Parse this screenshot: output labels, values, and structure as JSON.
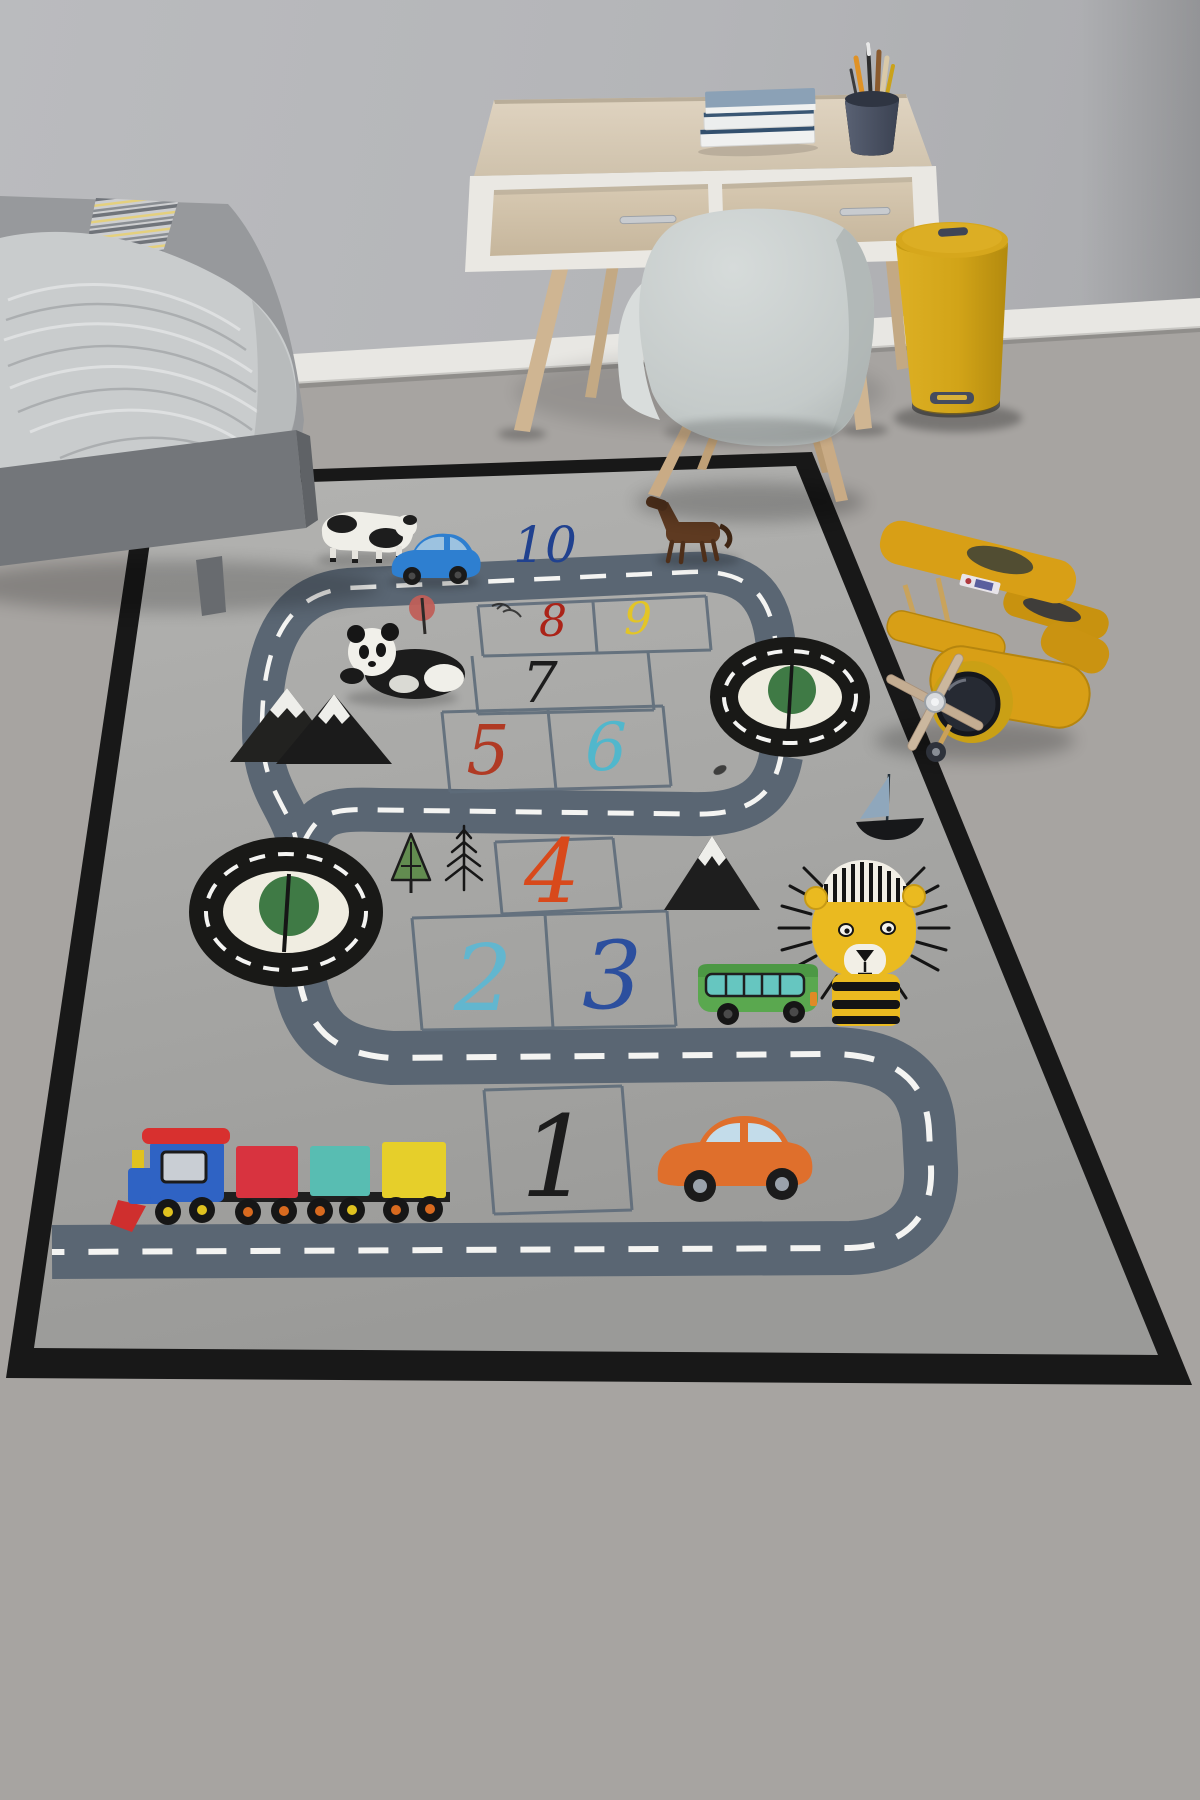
{
  "scene": {
    "setting": "children's room corner with play rug",
    "wall": {
      "color": "#b4b5b8",
      "baseboard_color": "#e8e7e3"
    },
    "floor": {
      "color": "#a7a4a1",
      "material": "concrete"
    },
    "furniture": [
      {
        "name": "bed",
        "frame_color": "#73767a",
        "bedding_color": "#97999c",
        "blanket_color": "#c9cccd",
        "runner_stripe_colors": [
          "#cdced0",
          "#70747a",
          "#e4d07e"
        ]
      },
      {
        "name": "desk",
        "wood_color": "#d6c9b4",
        "trim_color": "#eae8e3",
        "legs_color": "#cfb592",
        "handle_color": "#c8cbcf"
      },
      {
        "name": "book-stack",
        "cover_color": "#8ba1b6",
        "pages_color": "#f0f1f0",
        "count": 3
      },
      {
        "name": "pencil-cup",
        "cup_color": "#495163",
        "pencil_colors": [
          "#e09225",
          "#2d2d2d",
          "#8a5a2e",
          "#d9c9a8",
          "#caa21a"
        ]
      },
      {
        "name": "chair",
        "shell_color": "#c7cdcc",
        "legs_color": "#c9ab85"
      },
      {
        "name": "trash-bin",
        "color": "#d2a418",
        "lid_color": "#d6a71c"
      },
      {
        "name": "toy-biplane",
        "color": "#d89f16",
        "engine_color": "#262a33",
        "propeller_color": "#cbb79e"
      }
    ]
  },
  "rug": {
    "base_color": "#a9a9a7",
    "border_color": "#181818",
    "road_color": "#5a6673",
    "road_dash_color": "#f4f4f2",
    "grid_line_color": "#5e6c7a",
    "roundabouts": {
      "count": 2,
      "ring_color": "#191917",
      "island_color": "#f0ede1",
      "tree_color": "#3f7a45"
    },
    "numbers": [
      {
        "label": "1",
        "color": "#1c1c1c"
      },
      {
        "label": "2",
        "color": "#62b6cf"
      },
      {
        "label": "3",
        "color": "#2c4f9e"
      },
      {
        "label": "4",
        "color": "#d8491b"
      },
      {
        "label": "5",
        "color": "#b03a24"
      },
      {
        "label": "6",
        "color": "#51b7cc"
      },
      {
        "label": "7",
        "color": "#1d1d1d"
      },
      {
        "label": "8",
        "color": "#ab2318"
      },
      {
        "label": "9",
        "color": "#e3c526"
      },
      {
        "label": "10",
        "color": "#20418f"
      }
    ],
    "motifs": [
      "cow",
      "panda",
      "horse",
      "blue-toy-car",
      "mountains",
      "pine-trees",
      "lollipop-tree",
      "sailboat",
      "lion",
      "green-bus",
      "orange-car",
      "toy-train"
    ],
    "train_colors": [
      "#2f63c4",
      "#d8333f",
      "#58bdb2",
      "#e6cf2a"
    ]
  }
}
